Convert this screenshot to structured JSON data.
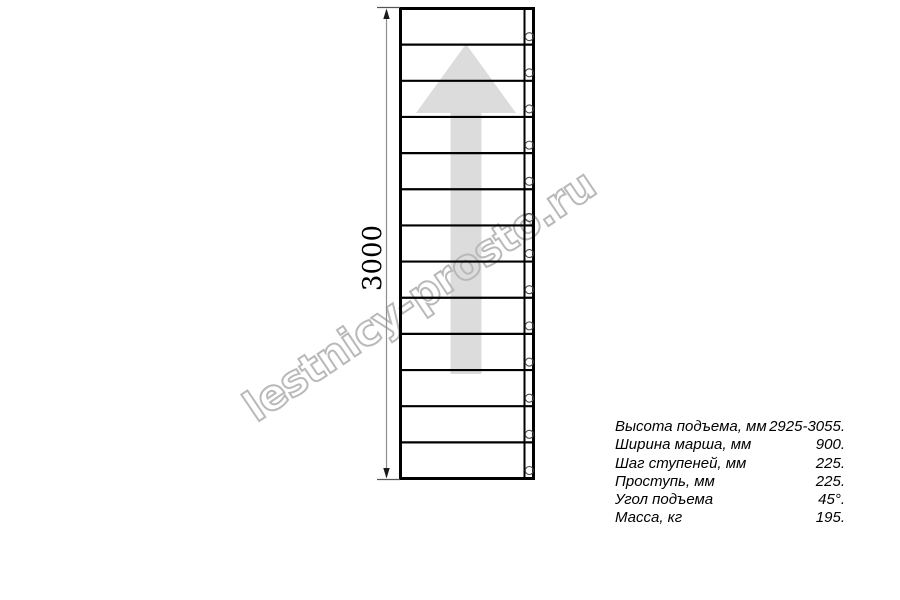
{
  "drawing": {
    "type": "ladder-plan-top-view",
    "dimension_label": "3000",
    "ladder": {
      "treads": 13,
      "fastener_holes": 13
    },
    "direction_arrow": "up"
  },
  "watermark": {
    "text": "lestnicy-prosto.ru"
  },
  "specs": {
    "rows": [
      {
        "label": "Высота подъема, мм",
        "value": "2925-3055."
      },
      {
        "label": "Ширина марша, мм",
        "value": "900."
      },
      {
        "label": "Шаг ступеней, мм",
        "value": "225."
      },
      {
        "label": "Проступь, мм",
        "value": "225."
      },
      {
        "label": "Угол подъема",
        "value": "45°."
      },
      {
        "label": "Масса, кг",
        "value": "195."
      }
    ]
  },
  "colors": {
    "arrow_fill": "#dcdcdc",
    "watermark_stroke": "#b9b9b9",
    "line": "#000000",
    "dim_line": "#8f8f8f",
    "ext_line": "#555555",
    "hole_stroke": "#4a4a4a"
  }
}
